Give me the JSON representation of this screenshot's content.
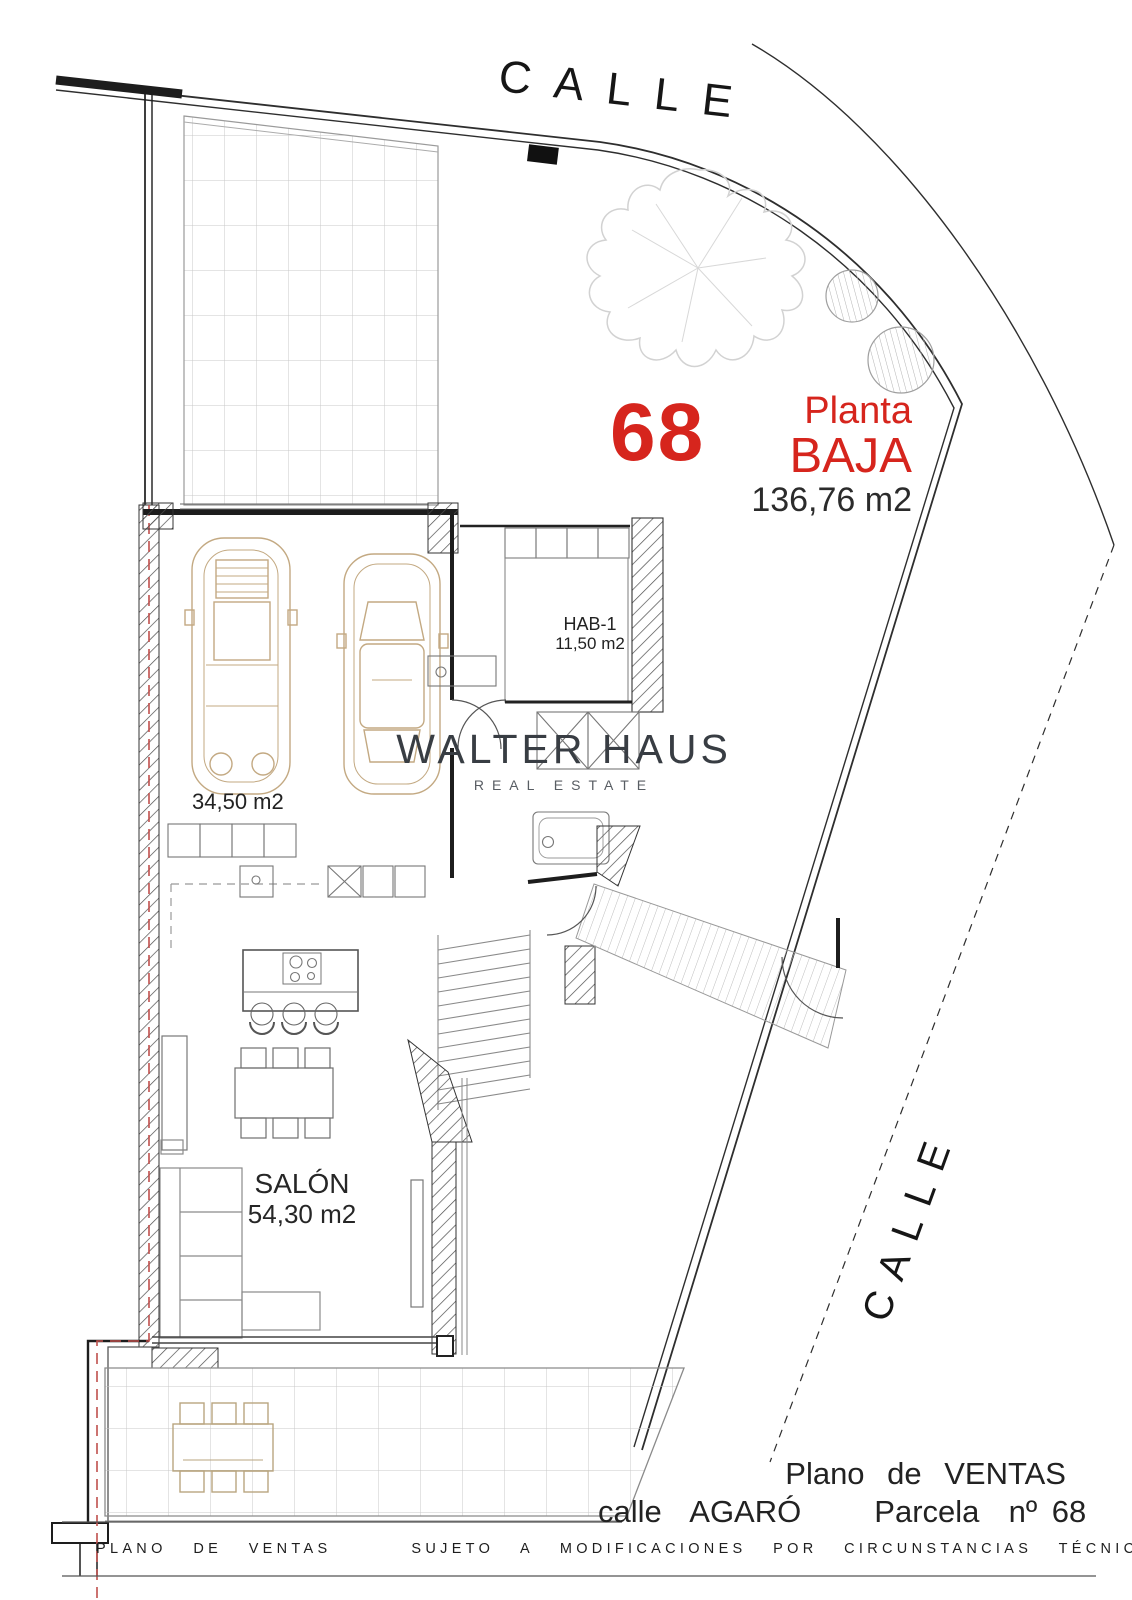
{
  "streets": {
    "top_label": "CALLE",
    "side_label": "CALLE"
  },
  "parcel": {
    "number": "68",
    "plant_line1": "Planta",
    "plant_line2": "BAJA",
    "total_area": "136,76 m2"
  },
  "rooms": {
    "bedroom": {
      "name": "HAB-1",
      "area": "11,50 m2"
    },
    "garage": {
      "area": "34,50 m2"
    },
    "living": {
      "name": "SALÓN",
      "area": "54,30 m2"
    }
  },
  "watermark": {
    "brand": "WALTER HAUS",
    "tagline": "REAL ESTATE"
  },
  "title_block": {
    "line1": "Plano de VENTAS",
    "line2": "calle  AGARÓ     Parcela  nº 68"
  },
  "footer": {
    "disclaimer": "PLANO  DE  VENTAS      SUJETO  A  MODIFICACIONES  POR  CIRCUNSTANCIAS  TÉCNICAS"
  },
  "colors": {
    "accent_red": "#d6251d",
    "ink": "#1f1f1f",
    "watermark_gray": "#383d43",
    "furniture_tan": "#c3a982",
    "boundary_red_dash": "#c0504d",
    "grid_gray": "#c9c9c9"
  }
}
